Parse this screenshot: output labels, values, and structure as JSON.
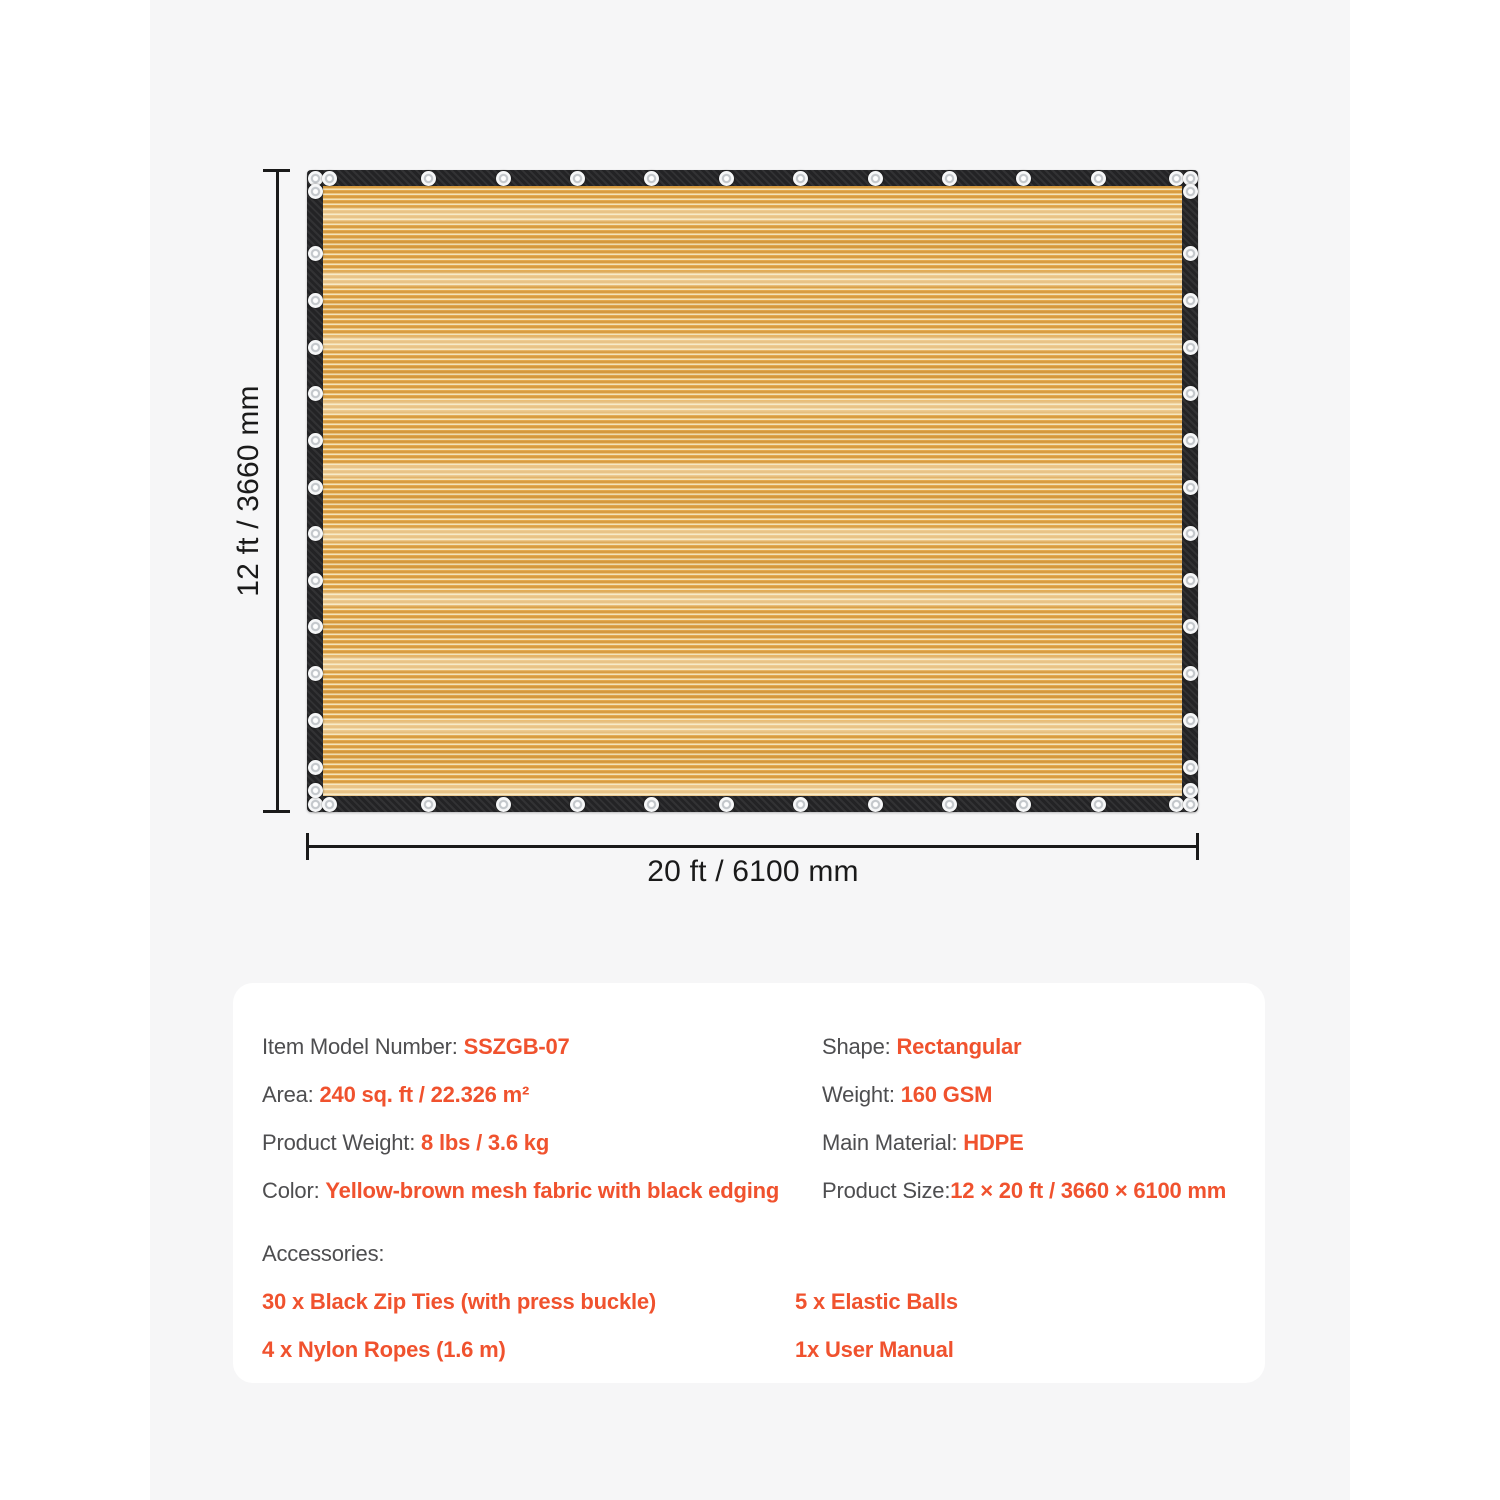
{
  "diagram": {
    "height_label": "12 ft / 3660 mm",
    "width_label": "20 ft / 6100 mm"
  },
  "specs": {
    "left": [
      {
        "label": "Item Model Number: ",
        "value": "SSZGB-07"
      },
      {
        "label": "Area: ",
        "value": "240 sq. ft / 22.326 m²"
      },
      {
        "label": "Product Weight: ",
        "value": "8 lbs / 3.6 kg"
      },
      {
        "label": "Color: ",
        "value": "Yellow-brown mesh fabric with black edging"
      }
    ],
    "right": [
      {
        "label": "Shape: ",
        "value": "Rectangular"
      },
      {
        "label": "Weight: ",
        "value": "160 GSM"
      },
      {
        "label": "Main Material: ",
        "value": "HDPE"
      },
      {
        "label": "Product Size:",
        "value": "12 × 20 ft / 3660 × 6100 mm"
      }
    ],
    "accessories_title": "Accessories:",
    "accessories": [
      {
        "text": "30 x Black Zip Ties (with press buckle)"
      },
      {
        "text": "5 x Elastic Balls"
      },
      {
        "text": "4 x Nylon Ropes (1.6 m)"
      },
      {
        "text": "1x User Manual"
      }
    ]
  },
  "colors": {
    "accent_orange": "#f0522e",
    "label_gray": "#4e4e50",
    "dimension_black": "#1a1a1a",
    "fabric_tan": "#e3aa52",
    "edging_black": "#232325",
    "band_gray": "#f6f6f7"
  }
}
